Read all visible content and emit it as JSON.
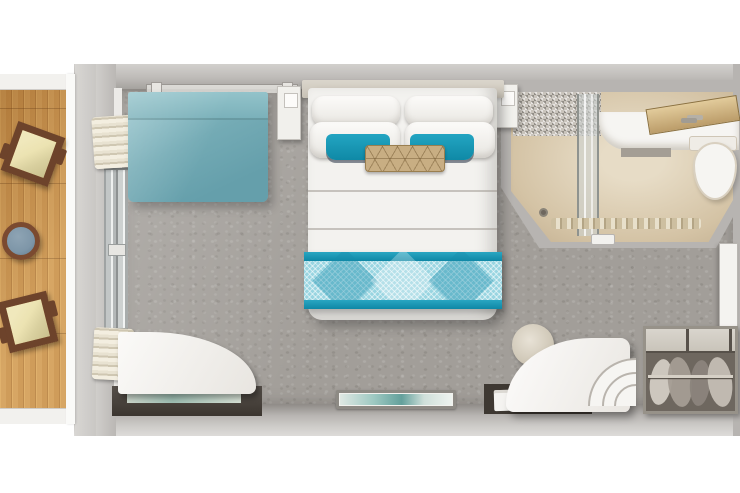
{
  "document": {
    "kind": "cruise-stateroom-floor-plan",
    "view": "top-down",
    "width_px": 740,
    "height_px": 493,
    "visible_text": ""
  },
  "palette": {
    "page-bg": "#ffffff",
    "carpet": "#a29e99",
    "carpet-shadow": "#837f7a",
    "wall-light": "#d2d0cd",
    "wall-mid": "#b7b4b1",
    "wall-dark": "#8f8b87",
    "counter-dark": "#423c35",
    "sofa-teal": "#74abb5",
    "sofa-teal-light": "#8fc0c8",
    "accent-teal": "#1395b4",
    "runner-light": "#99d5e1",
    "pillow-white": "#f5f4f1",
    "pillow-gold": "#c8ae83",
    "deck-wood": "#cf9a55",
    "deck-wood-dark": "#b17a3b",
    "chair-frame": "#6d432b",
    "chair-cushion": "#ece3b2",
    "table-top": "#7e96a8",
    "bath-floor": "#d4c3a5",
    "bath-floor-light": "#e7dcc6",
    "white-furniture": "#f6f5f2",
    "closet-interior": "#6e675f",
    "closet-shelf": "#d9d5cd",
    "art-teal": "#63a09b"
  },
  "rooms": {
    "balcony": {
      "name": "balcony",
      "items": [
        "deck-chair",
        "deck-chair",
        "balcony-table"
      ]
    },
    "stateroom": {
      "name": "stateroom",
      "items": [
        "sofa",
        "wall-shelf",
        "curtains",
        "sliding-glass-door",
        "nightstand-left",
        "nightstand-right",
        "queen-bed",
        "bed-pillows",
        "accent-pillows",
        "decorative-pillow",
        "bed-runner",
        "tv-artwork",
        "corner-desk",
        "glass-shelf",
        "desk-tray",
        "papers",
        "vanity-stool",
        "curved-chair"
      ]
    },
    "bathroom": {
      "name": "bathroom",
      "items": [
        "shower",
        "shower-door",
        "floor-drain",
        "vanity-sink",
        "towel-shelf",
        "toilet",
        "bath-mat",
        "bathroom-door"
      ]
    },
    "entry": {
      "name": "entry",
      "items": [
        "entry-door",
        "wardrobe",
        "clothes-rail",
        "hanging-clothes"
      ]
    }
  }
}
